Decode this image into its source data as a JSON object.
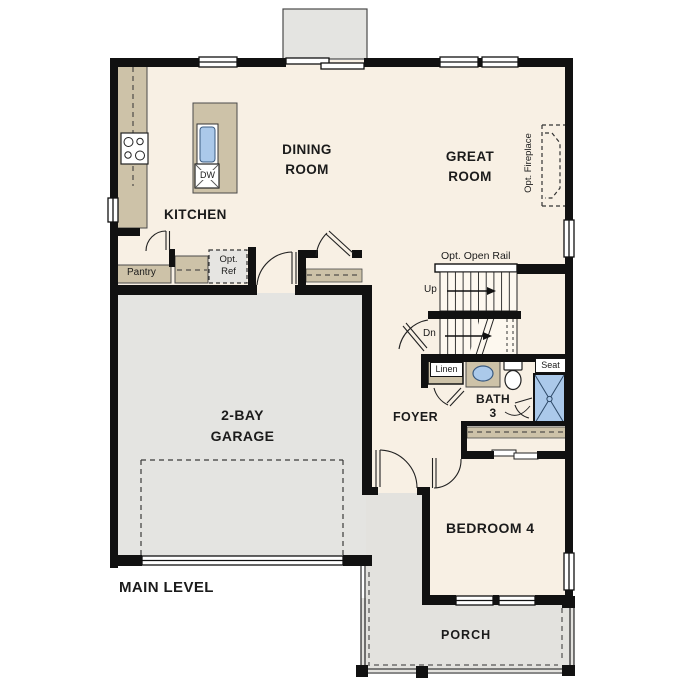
{
  "plan": {
    "level_label": "MAIN LEVEL"
  },
  "rooms": {
    "kitchen": {
      "label": "KITCHEN"
    },
    "dining": {
      "label": "DINING\nROOM"
    },
    "great_room": {
      "label": "GREAT\nROOM"
    },
    "garage": {
      "label": "2-BAY\nGARAGE"
    },
    "foyer": {
      "label": "FOYER"
    },
    "bath": {
      "label": "BATH\n3"
    },
    "bedroom4": {
      "label": "BEDROOM 4"
    },
    "porch": {
      "label": "PORCH"
    }
  },
  "annotations": {
    "pantry": "Pantry",
    "opt_ref": "Opt.\nRef",
    "dishwasher": "DW",
    "opt_fireplace": "Opt. Fireplace",
    "opt_open_rail": "Opt. Open Rail",
    "stairs_up": "Up",
    "stairs_down": "Dn",
    "linen": "Linen",
    "seat": "Seat"
  },
  "colors": {
    "floor": "#f8f0e4",
    "garage_floor": "#e4e4e1",
    "porch_floor": "#e3e2de",
    "counter": "#cdc2a8",
    "water_fixture": "#abc9ea",
    "optional_item": "#e6e5e2",
    "wall": "#111111"
  }
}
